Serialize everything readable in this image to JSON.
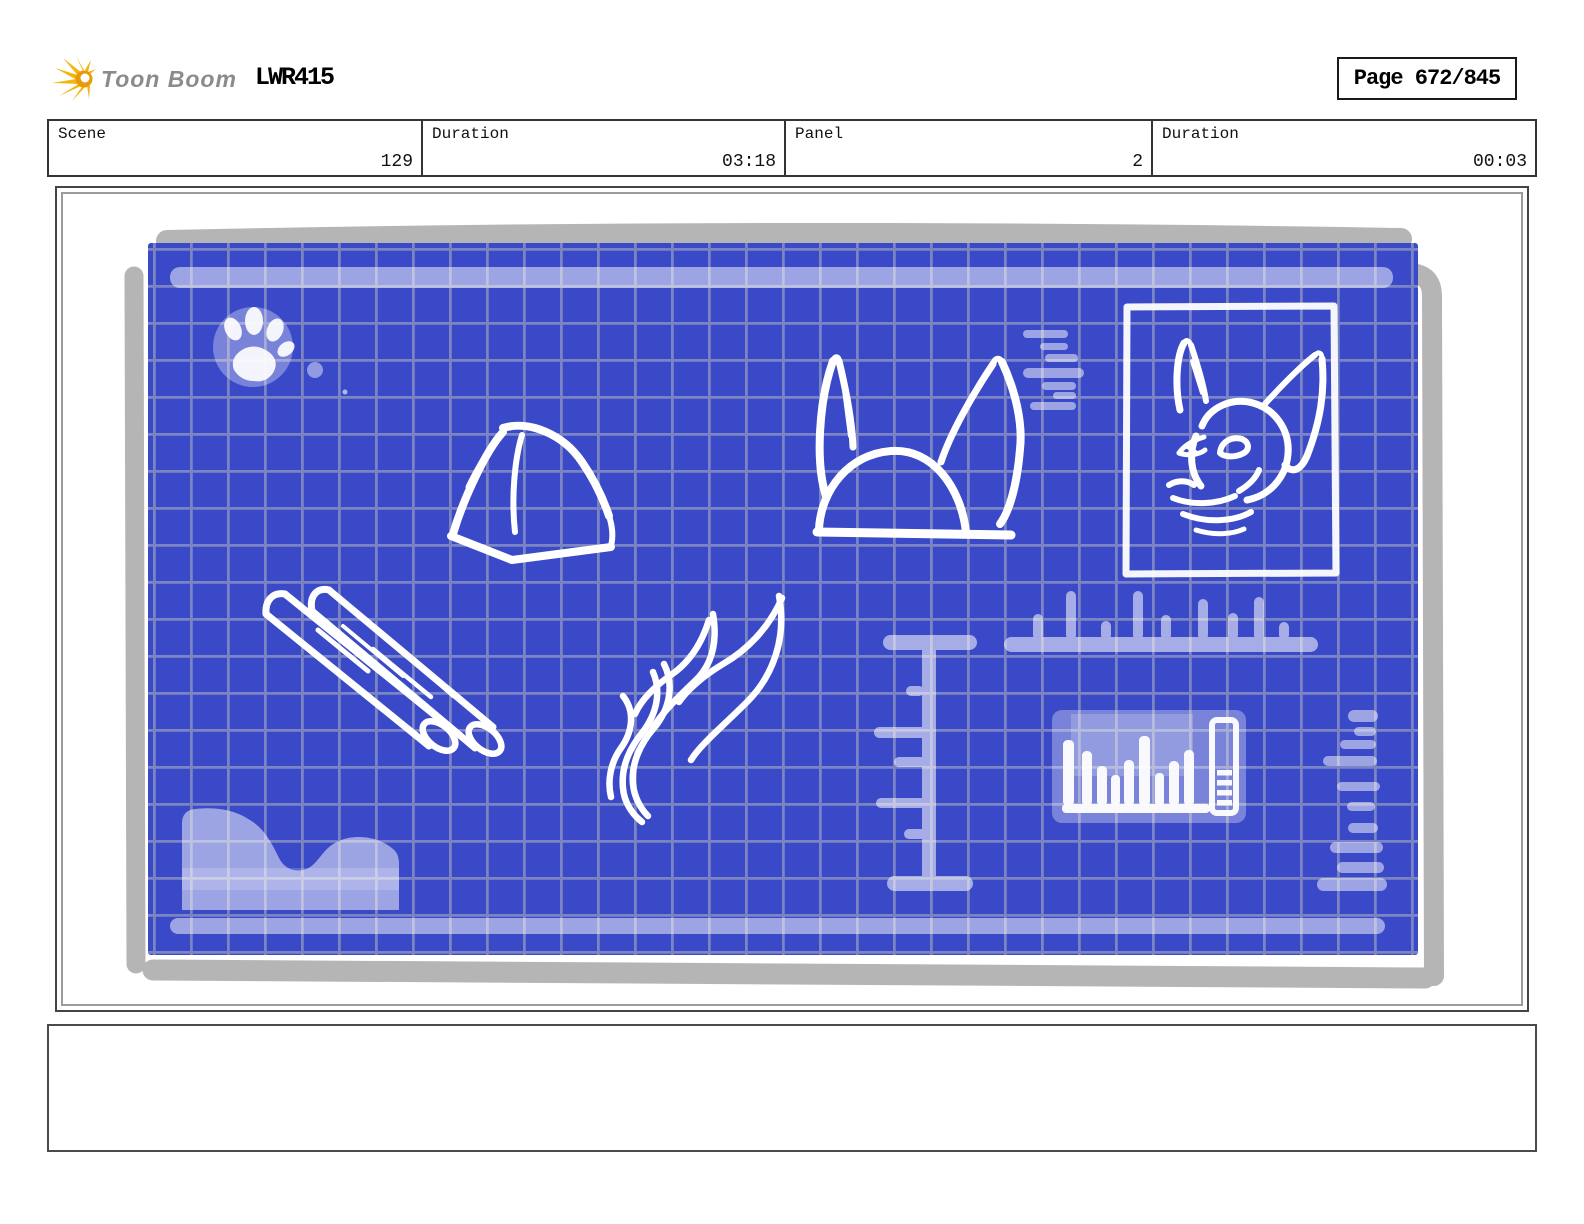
{
  "header": {
    "logo_text": "Toon Boom",
    "logo_icon": "toon-boom-burst-icon",
    "project_code": "LWR415",
    "page_label": "Page 672/845"
  },
  "info_bar": {
    "cells": [
      {
        "label": "Scene",
        "value": "129"
      },
      {
        "label": "Duration",
        "value": "03:18"
      },
      {
        "label": "Panel",
        "value": "2"
      },
      {
        "label": "Duration",
        "value": "00:03"
      }
    ]
  },
  "storyboard_panel": {
    "artwork_style": "blueprint-sketch",
    "elements": [
      "paw-print",
      "dome-sketch",
      "log-pair-sketch",
      "flame-wisp-sketch",
      "fox-ears-sketch",
      "framed-fox-head-sketch",
      "vertical-ruler",
      "horizontal-ruler",
      "bar-chart-sketch",
      "annotation-dashes",
      "terrain-mound"
    ]
  },
  "caption_box": {
    "text": ""
  },
  "colors": {
    "blueprint_blue": "#3a49c8",
    "grid_line": "#7c85c3",
    "shadow_gray": "#b5b5b5",
    "sketch_white": "#ffffff",
    "logo_yellow": "#f6b40e",
    "logo_orange": "#e89a0c",
    "logo_text_gray": "#8b8b8b",
    "border_dark": "#444444",
    "border_mid": "#9b9b9b",
    "text_black": "#111111"
  }
}
